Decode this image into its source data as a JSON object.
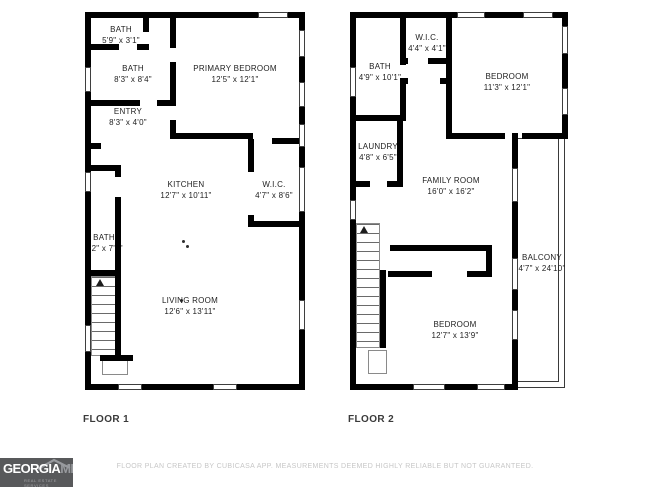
{
  "floor1": {
    "label": "FLOOR 1",
    "rooms": [
      {
        "name": "BATH",
        "dims": "5'9\" x 3'1\""
      },
      {
        "name": "BATH",
        "dims": "8'3\" x 8'4\""
      },
      {
        "name": "PRIMARY BEDROOM",
        "dims": "12'5\" x 12'1\""
      },
      {
        "name": "ENTRY",
        "dims": "8'3\" x 4'0\""
      },
      {
        "name": "KITCHEN",
        "dims": "12'7\" x 10'11\""
      },
      {
        "name": "W.I.C.",
        "dims": "4'7\" x 8'6\""
      },
      {
        "name": "BATH",
        "dims": "3'2\" x 7'6\""
      },
      {
        "name": "LIVING ROOM",
        "dims": "12'6\" x 13'11\""
      }
    ]
  },
  "floor2": {
    "label": "FLOOR 2",
    "rooms": [
      {
        "name": "BATH",
        "dims": "4'9\" x 10'1\""
      },
      {
        "name": "W.I.C.",
        "dims": "4'4\" x 4'1\""
      },
      {
        "name": "BEDROOM",
        "dims": "11'3\" x 12'1\""
      },
      {
        "name": "LAUNDRY",
        "dims": "4'8\" x 6'5\""
      },
      {
        "name": "FAMILY ROOM",
        "dims": "16'0\" x 16'2\""
      },
      {
        "name": "BALCONY",
        "dims": "4'7\" x 24'10\""
      },
      {
        "name": "BEDROOM",
        "dims": "12'7\" x 13'9\""
      }
    ]
  },
  "footer": {
    "disclaimer": "FLOOR PLAN CREATED BY CUBICASA APP. MEASUREMENTS DEEMED HIGHLY RELIABLE BUT NOT GUARANTEED."
  },
  "logo": {
    "brand": "GEORGIA",
    "suffix": "MLS",
    "tagline": "REAL ESTATE SERVICES"
  },
  "colors": {
    "wall": "#000000",
    "logo_bg": "#58595b",
    "footer_text": "#c7c7c7"
  }
}
